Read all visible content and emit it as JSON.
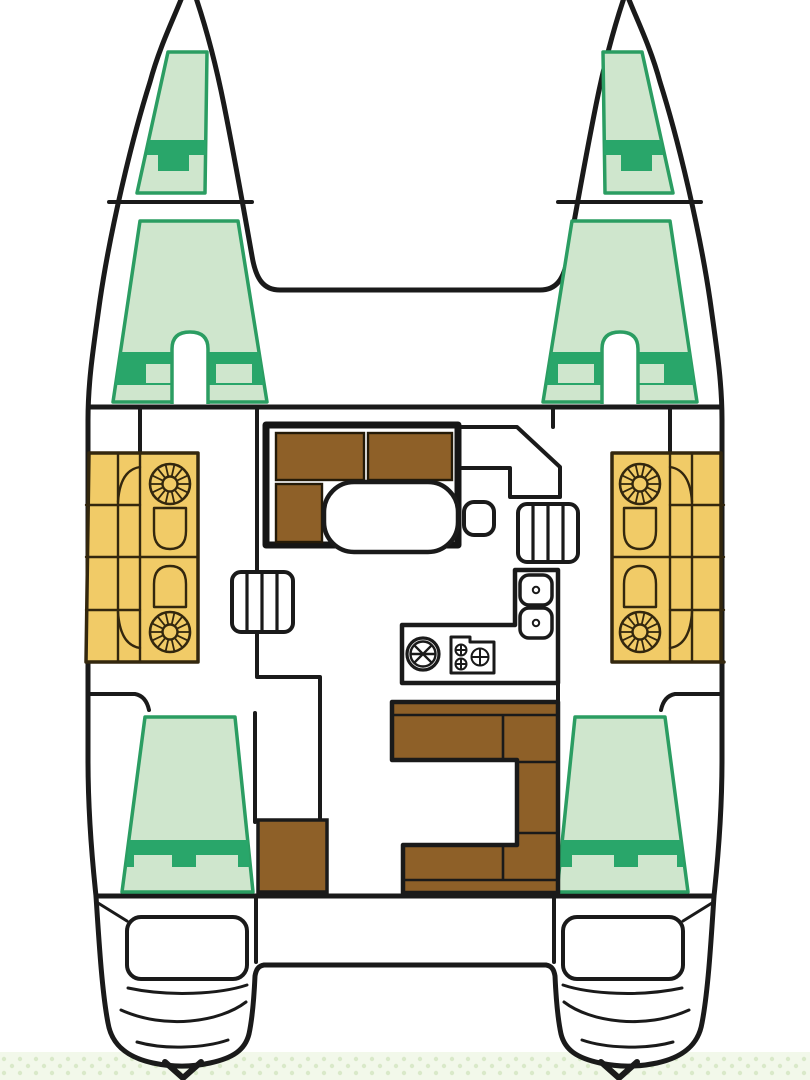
{
  "diagram": {
    "kind": "catamaran-yacht-floor-plan",
    "orientation": "bow-up",
    "views": "top-down deck layout, no text labels"
  },
  "colors": {
    "outline": "#1a1a1a",
    "frame_dark": "#151515",
    "white": "#ffffff",
    "berth_fill": "#cfe6cd",
    "berth_accent": "#29a66a",
    "berth_stroke": "#2b9d62",
    "wood": "#8e6028",
    "wood_stroke": "#241a08",
    "heads_fill": "#f1cb67",
    "heads_stroke": "#33270e",
    "water_bg": "#f2f8ea",
    "water_dot": "#d9e9c9"
  },
  "regions": [
    {
      "name": "port-forepeak-berth",
      "color": "berth_fill"
    },
    {
      "name": "starboard-forepeak-berth",
      "color": "berth_fill"
    },
    {
      "name": "port-forward-cabin-berth",
      "color": "berth_fill"
    },
    {
      "name": "starboard-forward-cabin-berth",
      "color": "berth_fill"
    },
    {
      "name": "port-heads-bathrooms",
      "color": "heads_fill"
    },
    {
      "name": "starboard-heads-bathrooms",
      "color": "heads_fill"
    },
    {
      "name": "salon-l-sofa",
      "color": "wood"
    },
    {
      "name": "salon-table",
      "color": "white"
    },
    {
      "name": "galley-counter-sinks-stove",
      "color": "white"
    },
    {
      "name": "port-companionway-steps",
      "color": "white"
    },
    {
      "name": "starboard-companionway-steps",
      "color": "white"
    },
    {
      "name": "port-aft-cabin-berth",
      "color": "berth_fill"
    },
    {
      "name": "starboard-aft-cabin-berth",
      "color": "berth_fill"
    },
    {
      "name": "cockpit-c-bench",
      "color": "wood"
    },
    {
      "name": "port-aft-locker",
      "color": "wood"
    },
    {
      "name": "port-transom-engine-hatch",
      "color": "white"
    },
    {
      "name": "starboard-transom-engine-hatch",
      "color": "white"
    },
    {
      "name": "water-texture-band",
      "color": "water_bg"
    }
  ],
  "showers": [
    {
      "cx": 170,
      "cy": 484
    },
    {
      "cx": 170,
      "cy": 632
    },
    {
      "cx": 640,
      "cy": 484
    },
    {
      "cx": 640,
      "cy": 632
    }
  ]
}
